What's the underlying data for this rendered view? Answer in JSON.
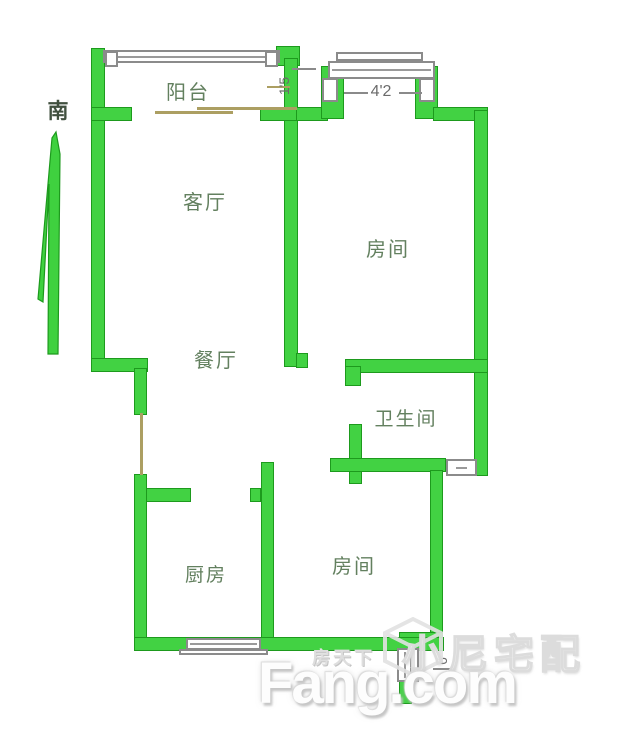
{
  "compass": {
    "south_label": "南"
  },
  "rooms": {
    "balcony": "阳台",
    "living_room": "客厅",
    "bedroom_top": "房间",
    "dining_room": "餐厅",
    "bathroom": "卫生间",
    "kitchen": "厨房",
    "bedroom_bottom": "房间"
  },
  "dimensions": {
    "top_window_width": "4'2",
    "balcony_side": "1'5",
    "entry_side": "6"
  },
  "watermark": {
    "site_name_cn": "房天下",
    "brand": "Fang.com",
    "partner": "小尼宅配"
  },
  "colors": {
    "wall": "#42d243",
    "wall_border": "#1d9a1d",
    "window_border": "#8b8b8b",
    "door_line": "#ac9f62",
    "room_label": "#63805f",
    "dimension_text": "#6b6b6b"
  }
}
